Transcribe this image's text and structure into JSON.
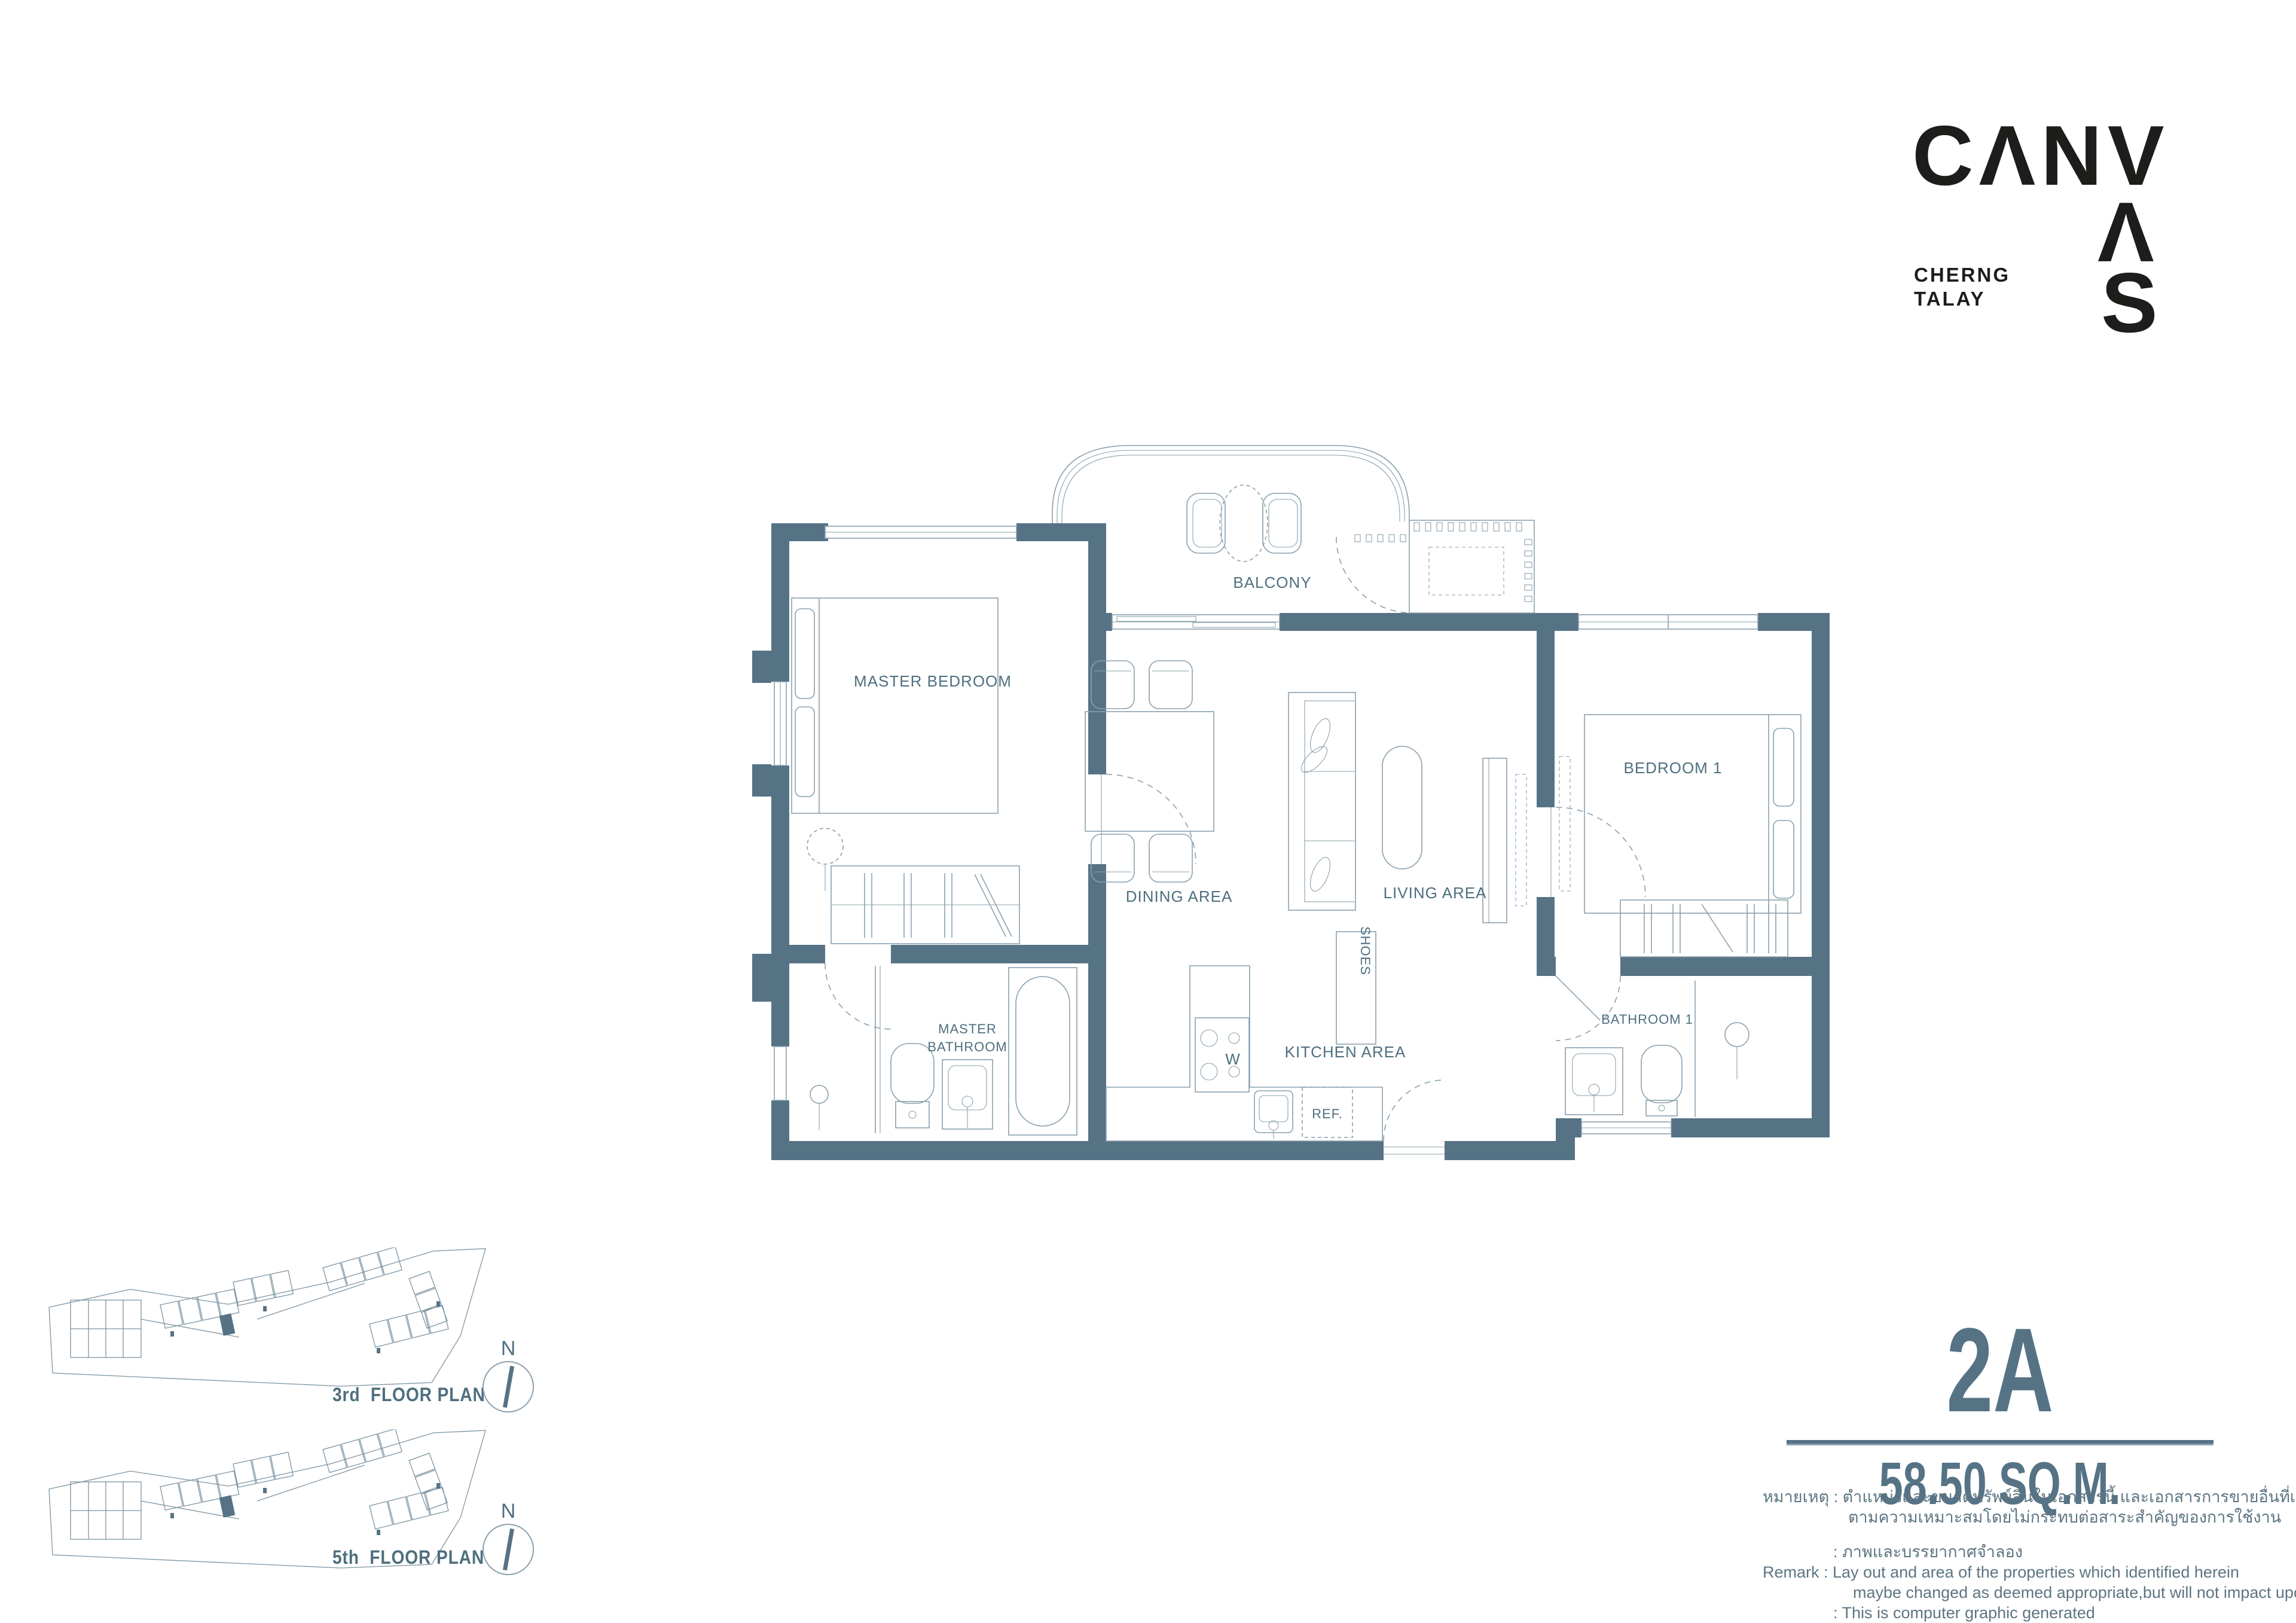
{
  "brand": {
    "name_row1": "CΛNV",
    "name_row2": "Λ",
    "name_row3": "S",
    "location_line1": "CHERNG",
    "location_line2": "TALAY"
  },
  "unit": {
    "code": "2A",
    "area": "58.50 SQ.M."
  },
  "rooms": {
    "balcony": "BALCONY",
    "master_bedroom": "MASTER BEDROOM",
    "dining": "DINING AREA",
    "living": "LIVING AREA",
    "bedroom1": "BEDROOM 1",
    "master_bathroom_line1": "MASTER",
    "master_bathroom_line2": "BATHROOM",
    "kitchen": "KITCHEN AREA",
    "bathroom1": "BATHROOM 1",
    "shoes": "SHOES",
    "fridge": "REF.",
    "washer": "W"
  },
  "thumbs": [
    {
      "label": "3rd  FLOOR PLAN",
      "compass": "N"
    },
    {
      "label": "5th  FLOOR PLAN",
      "compass": "N"
    }
  ],
  "remark": {
    "lines": [
      "หมายเหตุ : ตำแหน่งและขนาดทรัพย์สินในเอกสารนี้ และเอกสารการขายอื่นที่เกี่ยวข้อง อาจปรับเปลี่ยนได้",
      "ตามความเหมาะสมโดยไม่กระทบต่อสาระสำคัญของการใช้งาน",
      ": ภาพและบรรยากาศจำลอง",
      "Remark  : Lay out and area of the properties which identified herein",
      "maybe changed as deemed appropriate,but will not impact upon the use",
      ": This is computer graphic generated"
    ]
  },
  "colors": {
    "wall": "#567386",
    "label": "#4e6f7f",
    "line": "#8aa0ae",
    "logo": "#1d1d1b"
  }
}
